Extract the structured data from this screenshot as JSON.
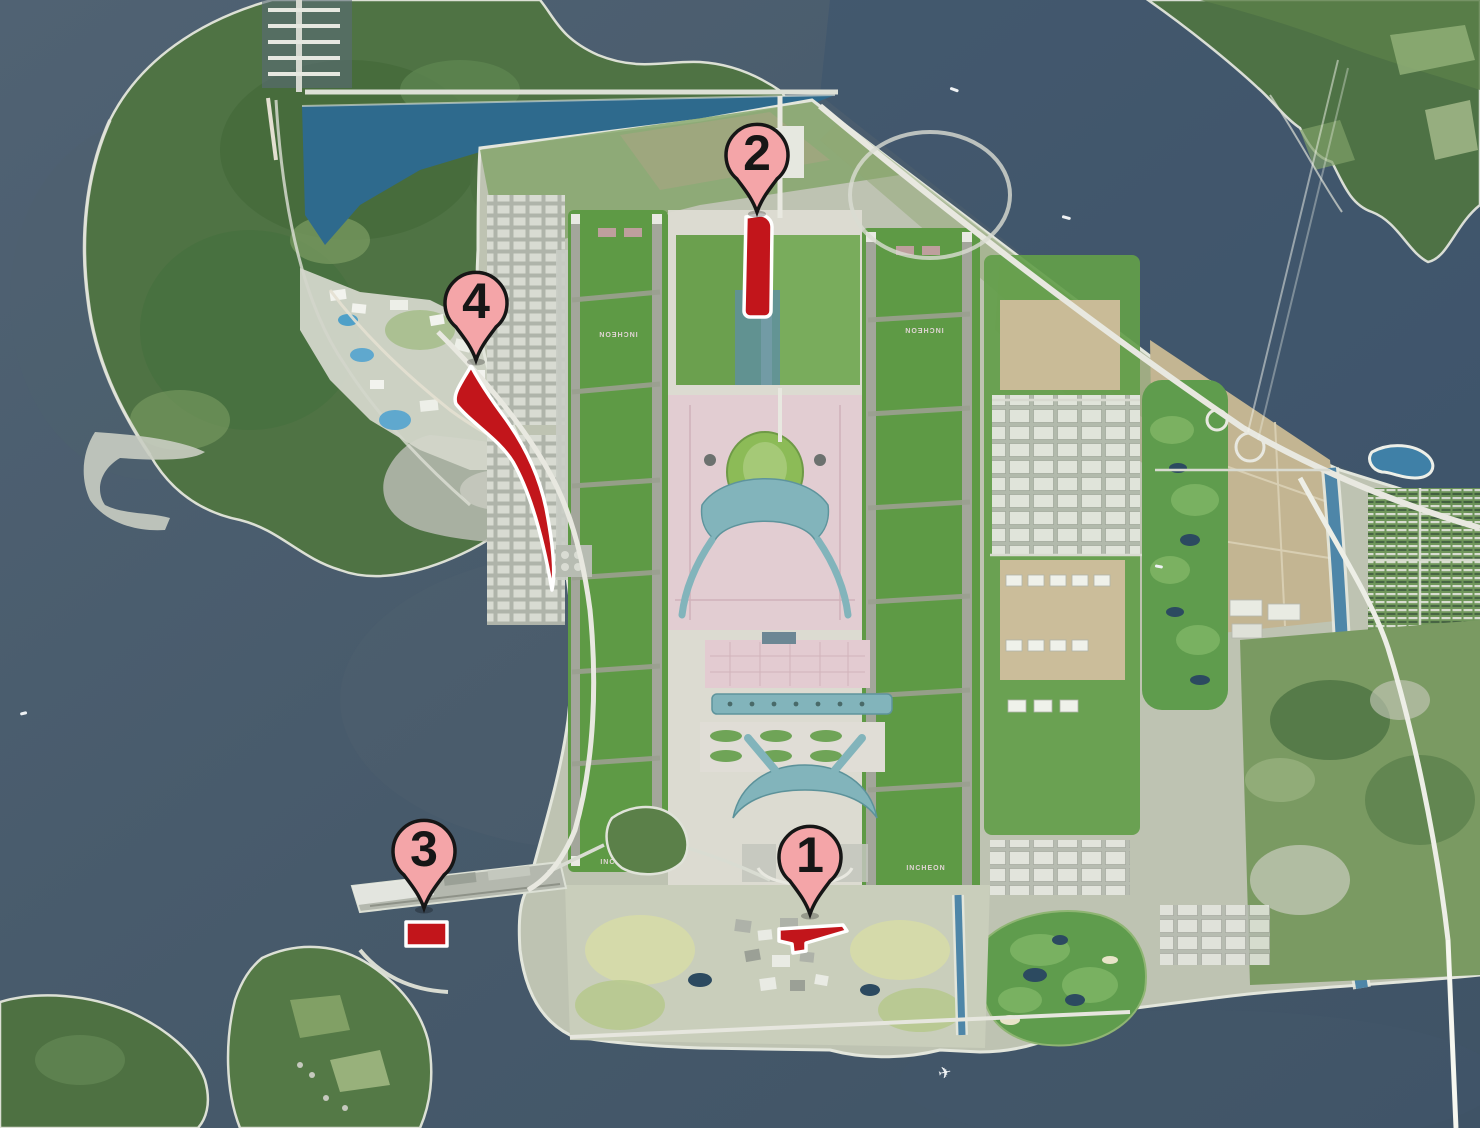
{
  "map": {
    "subject": "satellite-airport-masterplan",
    "runway_labels": [
      {
        "text": "INCHEON",
        "rotated": true
      },
      {
        "text": "INCHEON",
        "rotated": true
      },
      {
        "text": "INCHEON",
        "rotated": false
      },
      {
        "text": "INCHEON",
        "rotated": false
      }
    ]
  },
  "markers": [
    {
      "label": "1",
      "tip_x": 810,
      "tip_y": 914
    },
    {
      "label": "2",
      "tip_x": 757,
      "tip_y": 212
    },
    {
      "label": "3",
      "tip_x": 424,
      "tip_y": 908
    },
    {
      "label": "4",
      "tip_x": 476,
      "tip_y": 360
    }
  ],
  "highlight_zones": [
    {
      "marker": "1",
      "shape": "arrow"
    },
    {
      "marker": "2",
      "shape": "strip"
    },
    {
      "marker": "3",
      "shape": "rectangle"
    },
    {
      "marker": "4",
      "shape": "wedge"
    }
  ],
  "colors": {
    "sea": "#4A5C6B",
    "sea_deep": "#3C546D",
    "basin_water": "#2E6A8D",
    "forest_green": "#4F7344",
    "runway_green": "#5E9A45",
    "apron_pink": "#E2CDD2",
    "terminal_teal": "#82B4BB",
    "red_zone": "#C2151B",
    "pin_fill": "#F4A5A8",
    "pin_outline": "#161616",
    "canal_blue": "#4E86A8"
  }
}
